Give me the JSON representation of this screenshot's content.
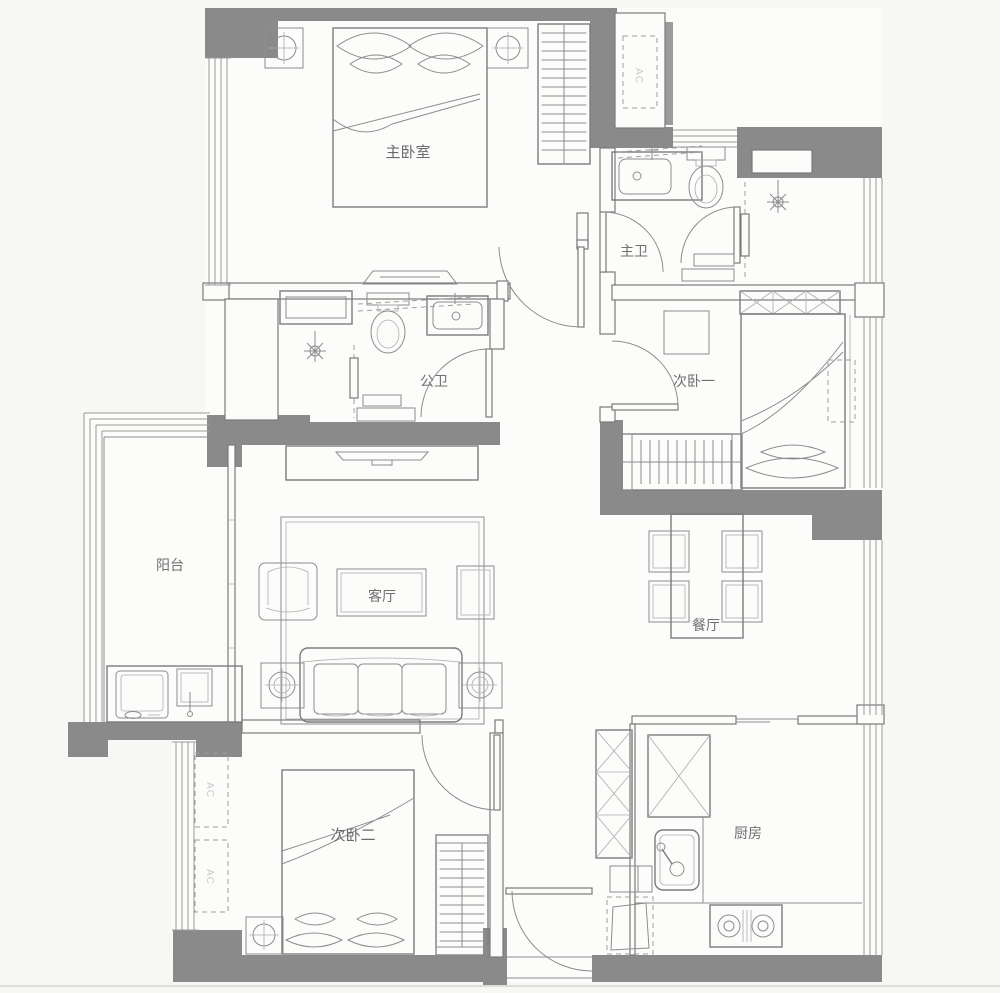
{
  "palette": {
    "wall_fill": "#8a8a8a",
    "hatch_fill": "#9c9c9c",
    "line": "#8d8d8d",
    "paper": "#fcfcfb",
    "background": "#f7f7f5",
    "label_color": "#6b6b6b",
    "ac_label_color": "#c9c9c9"
  },
  "rooms": [
    {
      "id": "master-bedroom",
      "label": "主卧室"
    },
    {
      "id": "master-bath",
      "label": "主卫"
    },
    {
      "id": "public-bath",
      "label": "公卫"
    },
    {
      "id": "bedroom-one",
      "label": "次卧一"
    },
    {
      "id": "balcony",
      "label": "阳台"
    },
    {
      "id": "living-room",
      "label": "客厅"
    },
    {
      "id": "dining-room",
      "label": "餐厅"
    },
    {
      "id": "bedroom-two",
      "label": "次卧二"
    },
    {
      "id": "kitchen",
      "label": "厨房"
    }
  ],
  "ac_units": [
    {
      "id": "ac-roof-platform",
      "label": "AC"
    },
    {
      "id": "ac-west-upper",
      "label": "AC"
    },
    {
      "id": "ac-west-lower",
      "label": "AC"
    }
  ]
}
